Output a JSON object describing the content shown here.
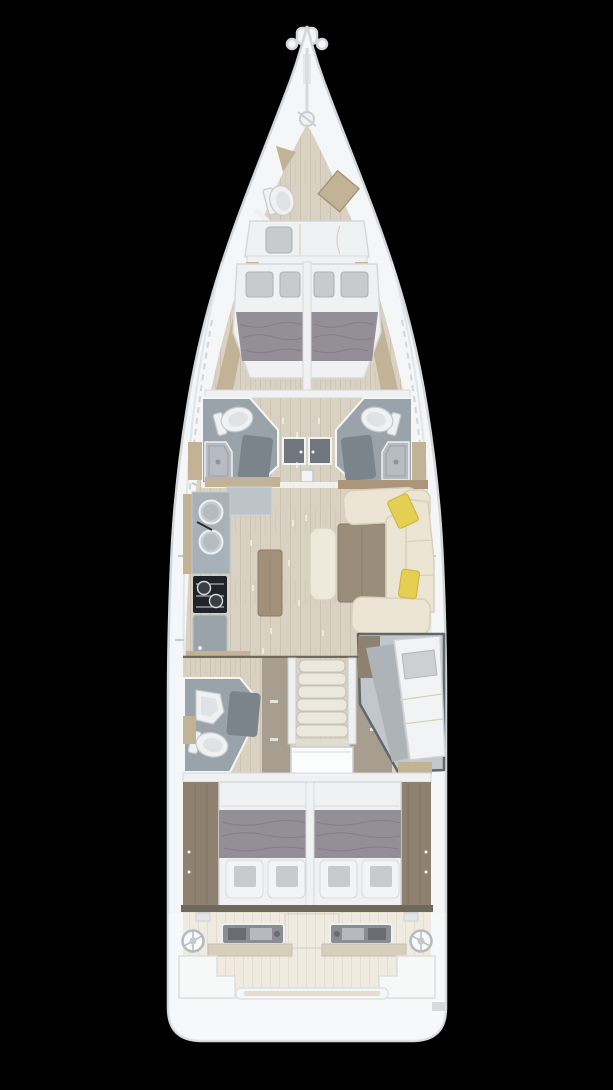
{
  "meta": {
    "title": "Sailing yacht interior floor plan (top view)",
    "canvas": {
      "width": 613,
      "height": 1090
    },
    "type": "yacht-floorplan"
  },
  "colors": {
    "background": "#000000",
    "hull": "#f4f6f7",
    "hullStroke": "#d3d7da",
    "deckInner": "#e3e6e9",
    "floorWood": "#d9d1c2",
    "floorPlank": "#ccc3b1",
    "woodTan": "#c2b296",
    "woodTanDark": "#ab967b",
    "woodBrown": "#8e8170",
    "taupePanel": "#a79e90",
    "bedWhite": "#f0f1f2",
    "bedEdge": "#d6d9db",
    "blanketGray": "#948e96",
    "blanketLine": "#7e7881",
    "pillowGray": "#c8cbcd",
    "pillowDark": "#aeb2b5",
    "bathFloor": "#9ba3aa",
    "bathMat": "#7b838b",
    "fixtureWhite": "#eff1f2",
    "counterGray": "#a9b1b8",
    "counterLight": "#bcc3c9",
    "stoveBlack": "#20242a",
    "cabinetGray": "#9aa3aa",
    "sofaCream": "#ece5d3",
    "sofaShadow": "#d8d0bc",
    "tableWood": "#9a8d7a",
    "islandWood": "#a3907a",
    "pillowYellow": "#e5cf52",
    "stairCream": "#ebe8dc",
    "stairEdge": "#c6c2b4",
    "cockpitSole": "#e9e3d5",
    "cockpitPlank": "#dbd3c2",
    "helmPod": "#5d6368",
    "helmScreen": "#9aa0a5",
    "metal": "#b9bec2",
    "darkTrim": "#6f685d"
  },
  "legend": {
    "regions": [
      "bow-deck",
      "skipper-cabin",
      "forward-cabin-port",
      "forward-cabin-starboard",
      "head-forward-port",
      "head-forward-starboard",
      "saloon",
      "galley",
      "aft-head",
      "companionway",
      "navigation-berth",
      "aft-cabin-port",
      "aft-cabin-starboard",
      "cockpit",
      "helm-port",
      "helm-starboard",
      "transom"
    ],
    "fixtures": [
      "windlass",
      "toilet",
      "shower-tray",
      "shower-mat",
      "sink",
      "stove",
      "galley-island",
      "saloon-table",
      "saloon-sofa",
      "yellow-cushion",
      "companionway-steps",
      "double-bed",
      "single-berth",
      "steering-wheel",
      "helm-console",
      "cockpit-bench",
      "mainsheet-traveler",
      "mast-post"
    ]
  }
}
